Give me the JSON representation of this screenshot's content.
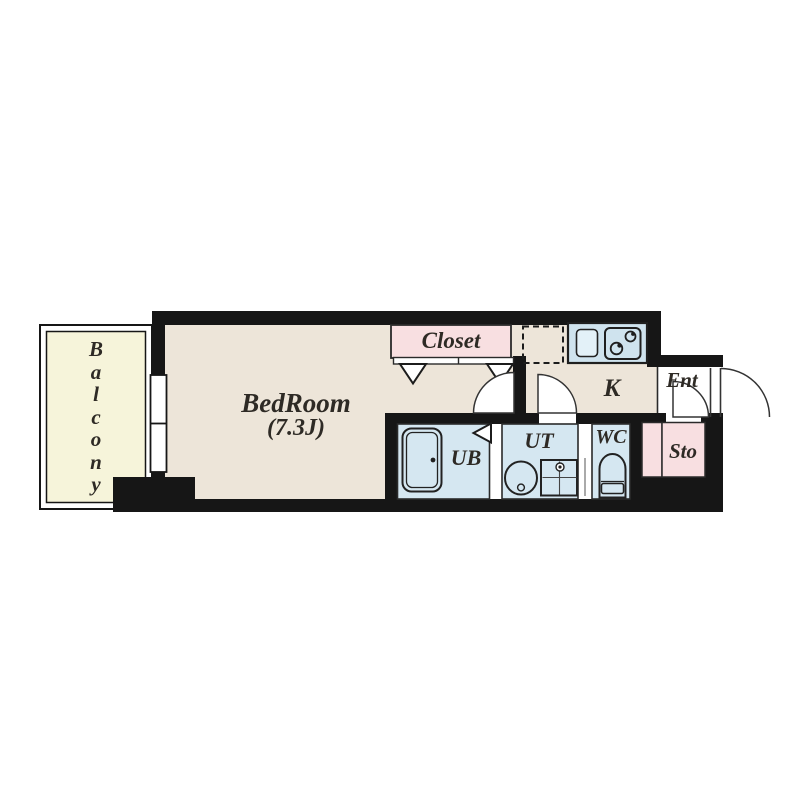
{
  "colors": {
    "wall": "#161616",
    "line": "#2a2a2a",
    "floor-beige": "#ede5d9",
    "balcony-yellow": "#f6f4da",
    "closet-pink": "#f8dfe1",
    "wet-blue": "#d5e7f1",
    "counter-blue": "#cfe3ee",
    "text": "#2e2a25"
  },
  "rooms": {
    "balcony": {
      "label": "Balcony",
      "letters": [
        "B",
        "a",
        "l",
        "c",
        "o",
        "n",
        "y"
      ]
    },
    "bedroom": {
      "name": "BedRoom",
      "size": "(7.3J)"
    },
    "closet": {
      "label": "Closet"
    },
    "kitchen": {
      "label": "K"
    },
    "entrance": {
      "label": "Ent"
    },
    "storage": {
      "label": "Sto"
    },
    "unit_bath": {
      "label": "UB"
    },
    "utility": {
      "label": "UT"
    },
    "toilet": {
      "label": "WC"
    }
  }
}
